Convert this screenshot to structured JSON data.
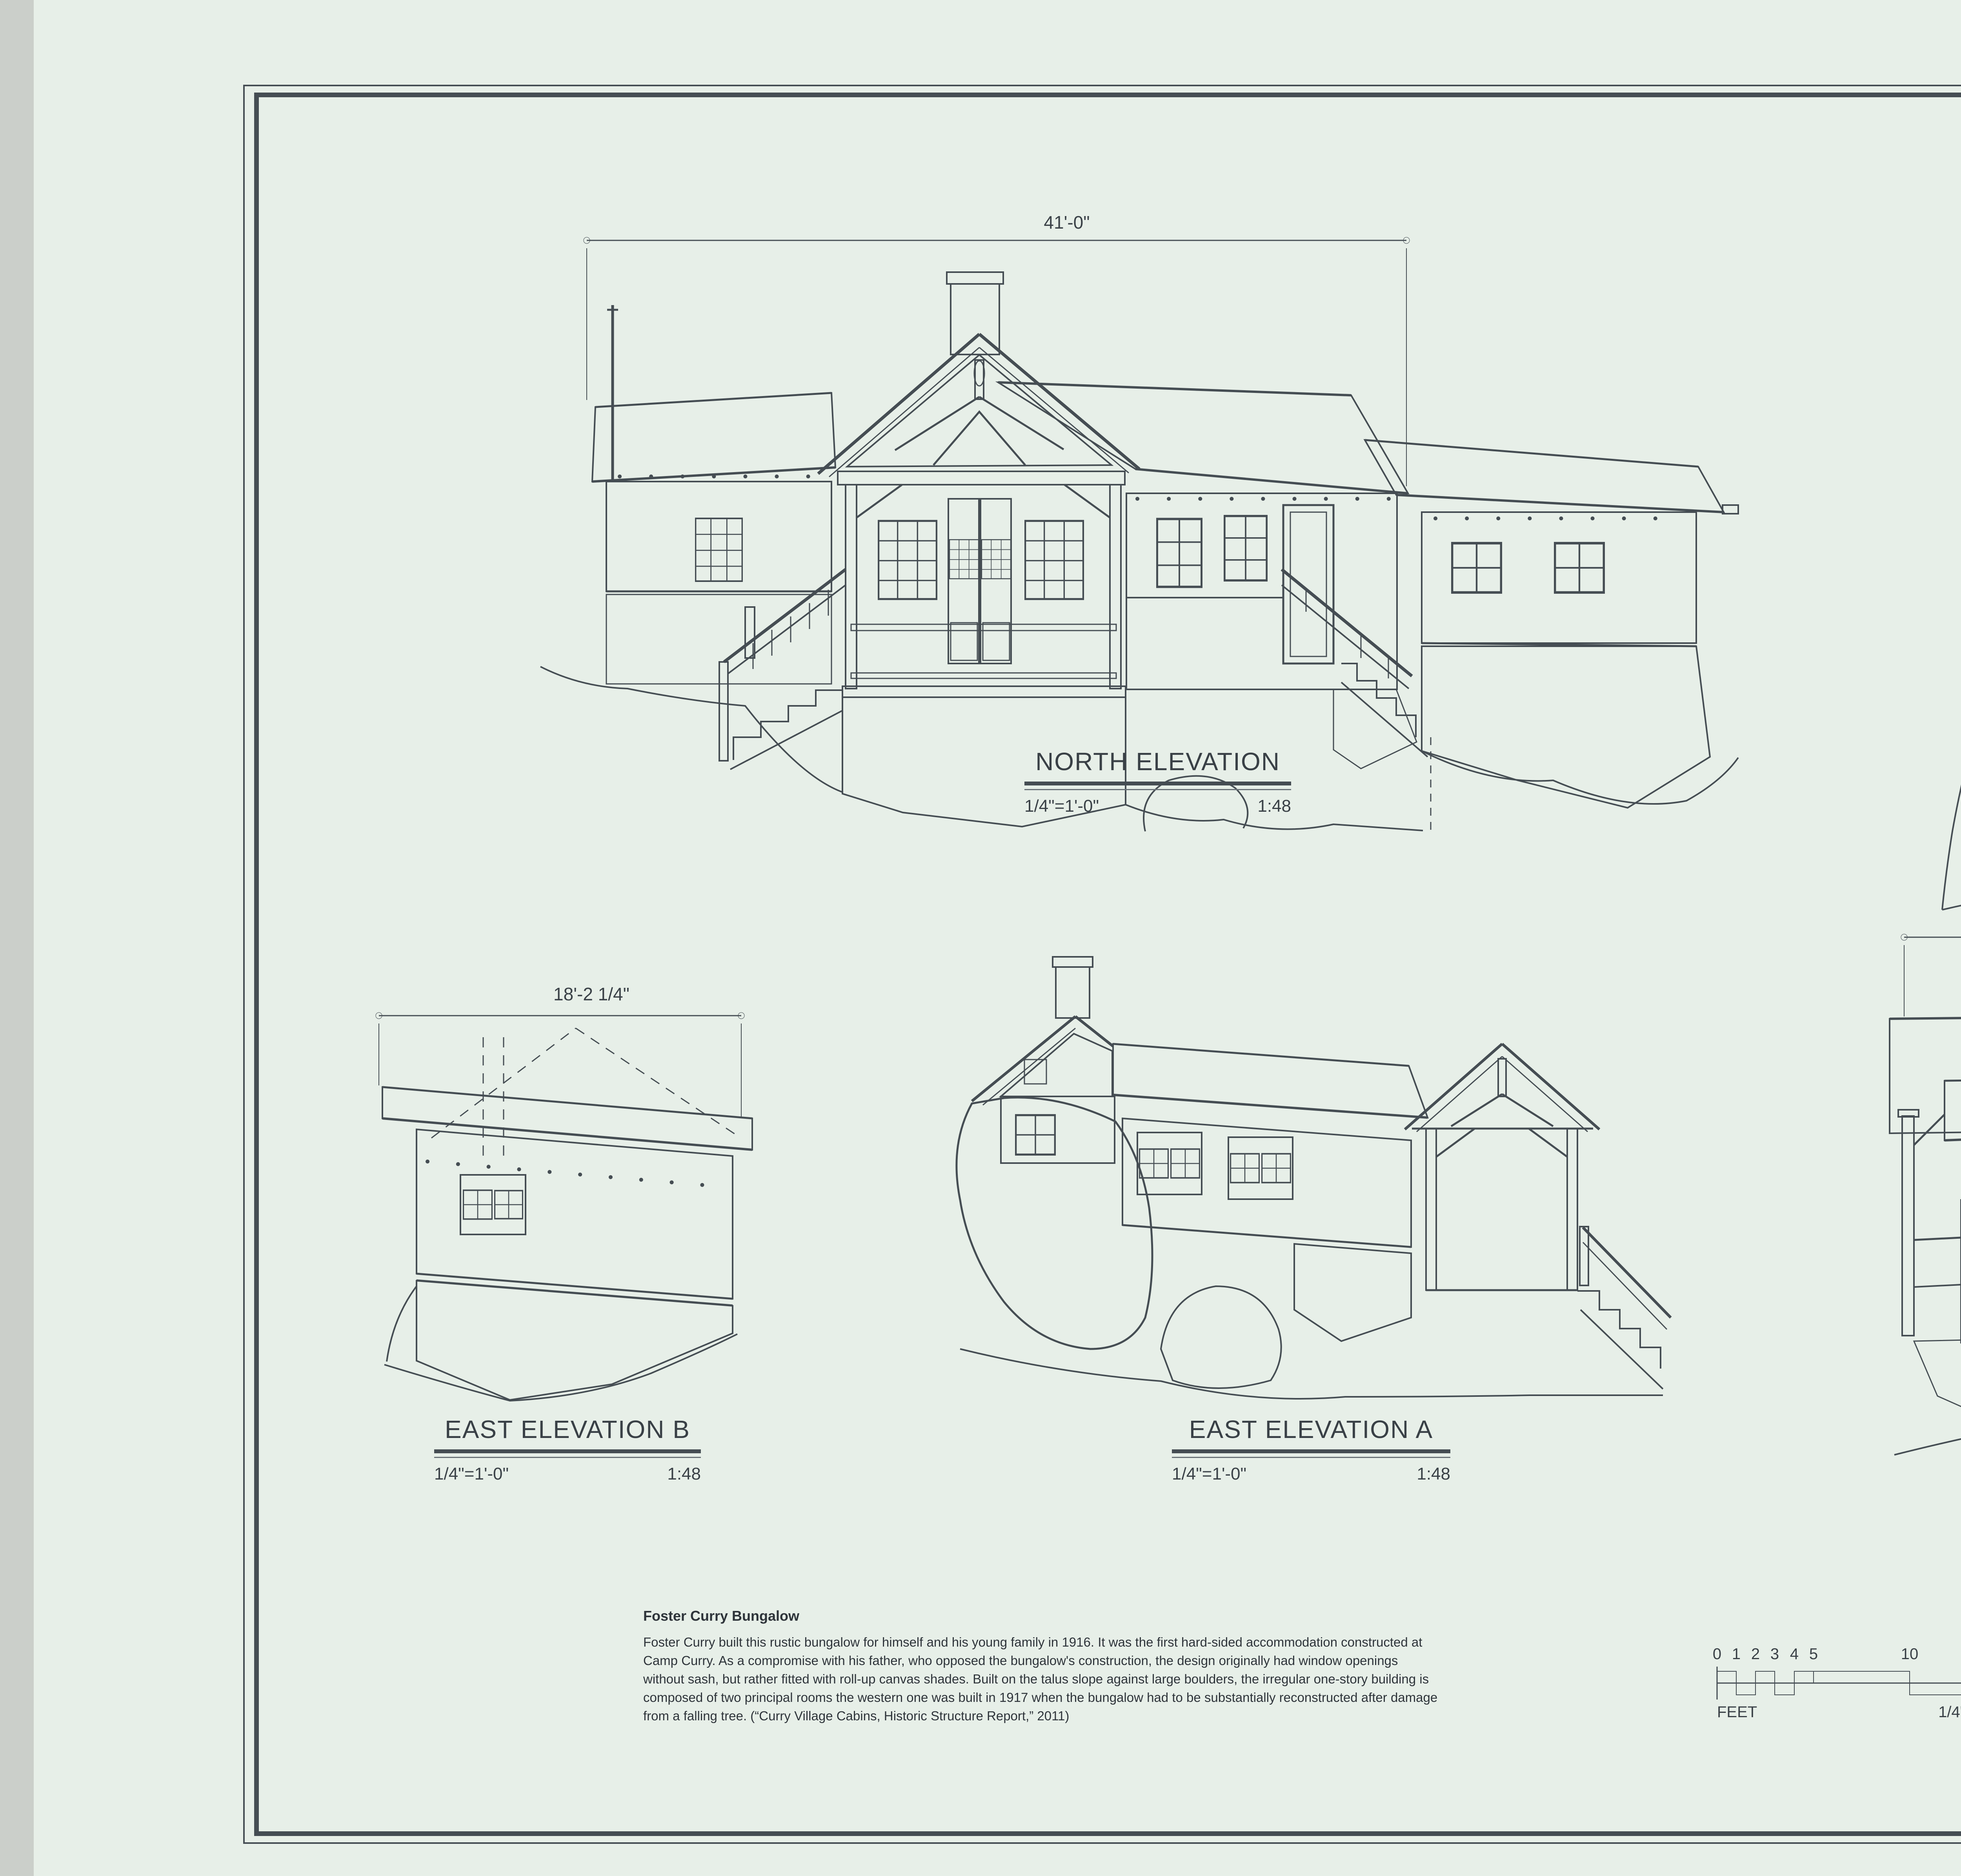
{
  "colors": {
    "paper": "#e7efe8",
    "ink": "#454d53",
    "scan_background": "#cbcfca"
  },
  "elevations": {
    "north": {
      "title": "NORTH ELEVATION",
      "scale": "1/4\"=1'-0\"",
      "ratio": "1:48",
      "width_dim": "41'-0\""
    },
    "west_a": {
      "title": "WEST ELEVATION A",
      "scale": "1/4\"=1'-0\"",
      "ratio": "1:48",
      "width_dim": "19'-5\"",
      "height_dim": "16'-6 3/4\""
    },
    "east_b": {
      "title": "EAST ELEVATION B",
      "scale": "1/4\"=1'-0\"",
      "ratio": "1:48",
      "width_dim": "18'-2 1/4\""
    },
    "east_a": {
      "title": "EAST ELEVATION A",
      "scale": "1/4\"=1'-0\"",
      "ratio": "1:48"
    },
    "west_b": {
      "title": "WEST ELEVATION B",
      "scale": "1/4\"=1'-0\"",
      "ratio": "1:48",
      "width_dim": "36'-2\""
    }
  },
  "note": {
    "heading": "Foster Curry Bungalow",
    "body": "Foster Curry built this rustic bungalow for himself and his young family in 1916.  It was the first hard-sided accommodation constructed at\nCamp Curry.  As a compromise with his father, who opposed the bungalow's construction, the design originally had window openings\nwithout sash, but rather fitted with roll-up canvas shades.  Built on the talus slope against large boulders, the irregular one-story building is\ncomposed of two principal rooms the western one was built in 1917 when the bungalow had to be substantially reconstructed after damage\nfrom a falling tree. (“Curry Village Cabins, Historic Structure Report,” 2011)"
  },
  "scale_bars": {
    "feet": {
      "unit_label": "FEET",
      "ticks": [
        "0",
        "1",
        "2",
        "3",
        "4",
        "5",
        "10",
        "15"
      ],
      "scale_note": "1/4\"=1'-0\""
    },
    "meters": {
      "unit_label": "METERS",
      "ticks": [
        "0",
        "1",
        "2",
        "3",
        "4",
        "5"
      ],
      "scale_note": "1:48"
    }
  },
  "title_block": {
    "index_line1": "LIBRARY OF CONGRESS",
    "index_line2": "INDEX NUMBER",
    "survey_line1": "HISTORIC AMERICAN",
    "survey_line2": "LANDSCAPES SURVEY",
    "survey_number": "CA-65-F",
    "sheet_label": "SHEET",
    "sheet_no_first": "2",
    "sheet_of": "OF",
    "sheet_no_total": "2",
    "state": "CALIFORNIA",
    "property_name": "CAMP CURRY, FOSTER CURRY BUNGALOW",
    "county": "MARIPOSA COUNTY",
    "park": "YOSEMITE NATIONAL PARK",
    "project_line1": "CAMP CURRY",
    "project_line2": "RECORDING PROJECT 2011-2012",
    "project_line3": "NATIONAL PARK SERVICE",
    "department": "UNITED STATES DEPARTMENT OF THE INTERIOR",
    "delineated_by": "DELINEATED BY:  JEREMY T. MAURO, ANNE E. KIDD, 2012, USING 2011-2012 FIELD NOTES AND A 2005 SURVEY BY DOCUMENTA.",
    "reproduction_credit": "IF REPRODUCED, PLEASE CREDIT THE HISTORIC AMERICAN LANDSCAPES SURVEY, NATIONAL PARK SERVICE, NAME OF DELINEATOR, DATE OF DRAWING"
  }
}
